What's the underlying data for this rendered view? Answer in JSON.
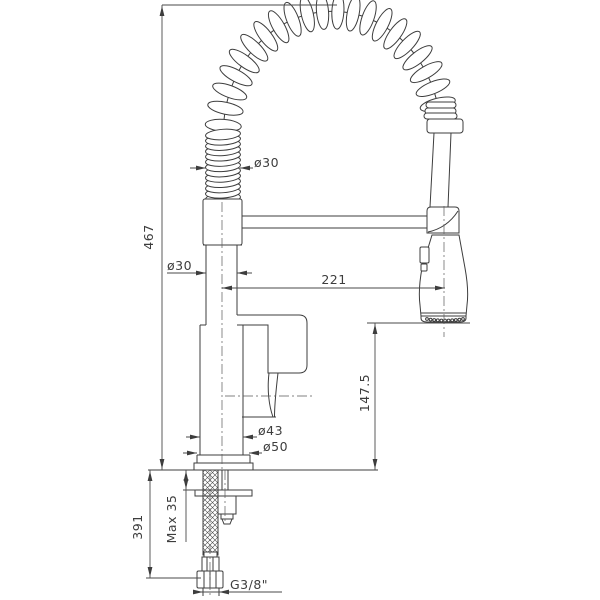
{
  "drawing": {
    "title": "kitchen-faucet-technical-drawing",
    "subject": "single-lever kitchen mixer with spring pull-down spray head",
    "background_color": "#ffffff",
    "line_color": "#3d3d3d",
    "units": "mm",
    "dimensions": {
      "total_height": "467",
      "spring_coil_diameter": "ø30",
      "column_diameter": "ø30",
      "spout_reach": "221",
      "outlet_to_deck": "147.5",
      "body_diameter": "ø43",
      "base_diameter": "ø50",
      "below_deck_length": "391",
      "max_counter_thickness": "Max 35",
      "supply_thread": "G3/8\""
    }
  }
}
